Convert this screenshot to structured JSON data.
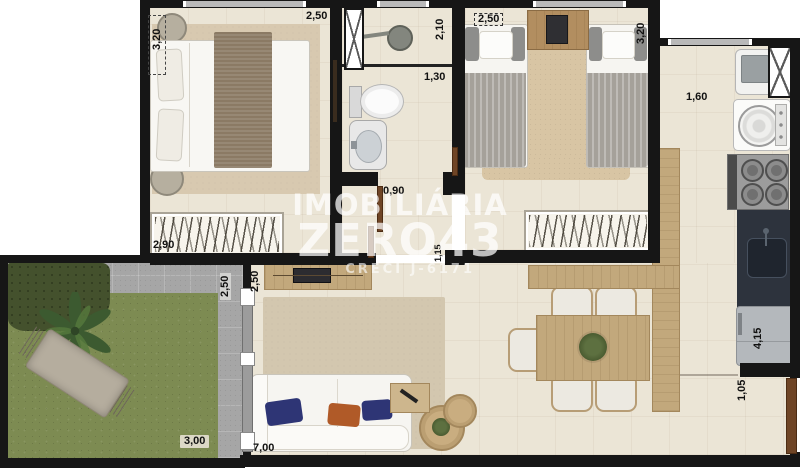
{
  "watermark": {
    "brand_line1": "IMOBILIÁRIA",
    "brand_line2": "ZERO43",
    "brand_line3": "CRECI J-6171"
  },
  "dimension_labels": {
    "bedroom1_depth": "3,20",
    "bedroom1_width": "2,50",
    "bedroom1_wardrobe": "2,90",
    "bathroom_depth": "2,10",
    "bathroom_width": "1,30",
    "bathroom_door": "0,90",
    "bedroom2_width": "2,50",
    "bedroom2_depth": "3,20",
    "kitchen_width": "1,60",
    "kitchen_depth": "4,15",
    "entry_passage": "1,05",
    "hall_opening": "1,15",
    "living_left_wall": "2,50",
    "living_width": "7,00",
    "garden_depth": "2,50",
    "garden_width": "3,00"
  },
  "colors": {
    "wall": "#161616",
    "floor": "#ebe5d6",
    "carpet": "#d8c9b0",
    "wood": "#c2a87c",
    "grass": "#7d8b52",
    "paver": "#a6a6a6",
    "dark_counter": "#2d333d",
    "pillow_blue": "#2e3575",
    "pillow_orange": "#b05a28",
    "watermark_text": "#ffffff"
  },
  "furniture_depicted": [
    "double-bed",
    "nightstands",
    "wardrobe",
    "shower",
    "toilet",
    "pedestal-sink",
    "single-beds",
    "kids-nightstand",
    "laundry-tank",
    "washing-machine",
    "cooktop-stove",
    "kitchen-sink-counter",
    "refrigerator",
    "dining-table",
    "dining-chairs",
    "wood-counter",
    "tv-console",
    "tv",
    "sofa",
    "throw-pillows",
    "side-table",
    "coffee-tables",
    "rug",
    "hammock",
    "palm-tree",
    "hedge",
    "lawn",
    "sliding-door",
    "entry-door"
  ]
}
